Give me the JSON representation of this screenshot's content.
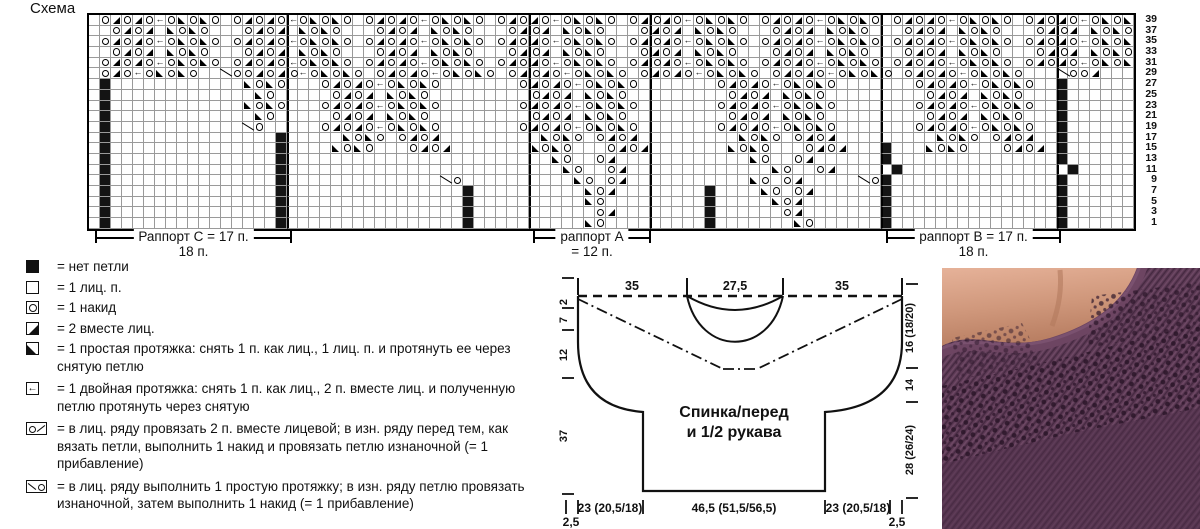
{
  "title": "Схема",
  "colors": {
    "ink": "#111111",
    "grid_line": "#9a9a9a",
    "yarn_purple": "#5b3953",
    "skin": "#cf977b"
  },
  "chart": {
    "cols": 95,
    "rows": 20,
    "row_numbers": [
      "39",
      "37",
      "35",
      "33",
      "31",
      "29",
      "27",
      "25",
      "23",
      "21",
      "19",
      "17",
      "15",
      "13",
      "11",
      "9",
      "7",
      "5",
      "3",
      "1"
    ],
    "thick_cols": [
      18,
      40,
      51,
      72,
      88
    ],
    "symbols": {
      ".": "knit-stitch",
      "#": "no-stitch",
      "O": "yarn-over",
      "/": "k2tog",
      "\\": "slip-decrease",
      "<": "double-decrease",
      "%": "increase-mark"
    },
    "grid": [
      ".O/O/O<O\\O\\O.O/O/O<O\\O\\O.O/O/O<O\\O\\O.O/O/O<O\\O\\O.O/O/O<O\\O\\O.O/O/O<O\\O\\O.O/O/O<O\\O\\O.O/O/O<O\\O\\",
      "..O/O/.\\O\\O...O/O/.\\O\\O...O/O/.\\O\\O...O/O/.\\O\\O...O/O/.\\O\\O...O/O/.\\O\\O...O/O/.\\O\\O...O/O/.\\O\\O",
      ".O/O/O<O\\O\\O.O/O/O<O\\O\\O.O/O/O<O\\O\\O.O/O/O<O\\O\\O.O/O/O<O\\O\\O.O/O/O<O\\O\\O.O/O/O<O\\O\\O.O/O/O<O\\O\\",
      "..O/O/.\\O\\O...O/O/.\\O\\O...O/O/.\\O\\O...O/O/.\\O\\O...O/O/.\\O\\O...O/O/.\\O\\O...O/O/.\\O\\O...O/O/.\\O\\O",
      ".O/O/O<O\\O\\O.O/O/O<O\\O\\O.O/O/O<O\\O\\O.O/O/O<O\\O\\O.O/O/O<O\\O\\O.O/O/O<O\\O\\O.O/O/O<O\\O\\O.O/O/O<O\\O\\",
      ".O/O<O\\O\\O..%OO/O/O<O\\O\\O.O/O/O<O\\O\\O.O/O/O<O\\O\\O.O/O/O<O\\O\\O.O/O/O<O\\O\\O.O/O/O<O\\O\\O...%OO/...",
      ".#............\\O\\O...O/O/O<O\\O\\O.......O/O/O<O\\O\\O.......O/O/O<O\\O\\O.......O/O/O<O\\O\\O..#......",
      ".#.............\\O.....O/O/.\\O\\O.........O/O/.\\O\\O.........O/O/.\\O\\O.........O/O/.\\O\\O...#......",
      ".#............\\O\\O...O/O/O<O\\O\\O.......O/O/O<O\\O\\O.......O/O/O<O\\O\\O.......O/O/O<O\\O\\O..#......",
      ".#.............\\O.....O/O/.\\O\\O.........O/O/.\\O\\O.........O/O/.\\O\\O.........O/O/.\\O\\O...#......",
      ".#............%O.....O/O/O<O\\O\\O.......O/O/O<O\\O\\O.......O/O/O<O\\O\\O.......O/O/O<O\\O\\O..#......",
      ".#...............#.....\\O\\O.O/O/.........\\O\\O.O/O/.........\\O\\O.O/O/.........\\O\\O.O/O/..#......",
      ".#...............#....\\O\\O...O/O/.......\\O\\O...O/O/.......\\O\\O...O/O/...#...\\O\\O...O/O/.#......",
      ".#...............#........................\\O..O/............\\O..O/......#...............#......",
      ".#...............#.........................\\O..O/.............\\O..O/.....#...............#......",
      ".#...............#..............%O..........\\O.O/...........\\O.O/.....%O#...............#......",
      ".#...............#................#..........\\O/........#....\\O.O/......#...............#......",
      ".#...............#................#..........\\O.........#.....\\O/.......#...............#......",
      ".#...............#................#...........O/........#......O/.......#...............#......",
      ".#...............#................#..........\\O.........#.......\\O......#...............#......"
    ]
  },
  "rapports": [
    {
      "line1": "Раппорт C = 17 п.",
      "line2": "18 п."
    },
    {
      "line1": "раппорт A",
      "line2": "= 12 п."
    },
    {
      "line1": "раппорт B = 17 п.",
      "line2": "18 п."
    }
  ],
  "legend": {
    "items": [
      {
        "icon": "no-stitch",
        "text": "= нет петли"
      },
      {
        "icon": "knit",
        "text": "= 1 лиц. п."
      },
      {
        "icon": "yarnover",
        "text": "= 1 накид"
      },
      {
        "icon": "k2tog",
        "text": "= 2 вместе лиц."
      },
      {
        "icon": "ssk",
        "text": "= 1 простая протяжка: снять 1 п. как лиц., 1 лиц. п. и протянуть ее через снятую петлю"
      },
      {
        "icon": "double-dec",
        "text": "= 1 двойная протяжка: снять 1 п. как лиц., 2 п. вместе лиц. и полученную петлю протянуть через снятую"
      },
      {
        "icon": "inc-right",
        "text": "= в лиц. ряду провязать 2 п. вместе лицевой; в изн. ряду перед тем, как вязать петли, выполнить 1 накид и провязать петлю изнаночной (= 1 прибавление)"
      },
      {
        "icon": "inc-left",
        "text": "= в лиц. ряду выполнить 1 простую протяжку; в изн. ряду петлю провязать изнаночной, затем выполнить 1 накид (= 1 прибавление)"
      }
    ]
  },
  "schematic": {
    "top_labels": [
      "35",
      "27,5",
      "35"
    ],
    "left_labels": [
      "2",
      "7",
      "12",
      "37"
    ],
    "right_labels": [
      "16 (18/20)",
      "14",
      "28 (26/24)"
    ],
    "bottom_labels": [
      "23 (20,5/18)",
      "46,5 (51,5/56,5)",
      "23 (20,5/18)"
    ],
    "corner_labels": [
      "2,5",
      "2,5"
    ],
    "piece_label_1": "Спинка/перед",
    "piece_label_2": "и 1/2 рукава"
  }
}
